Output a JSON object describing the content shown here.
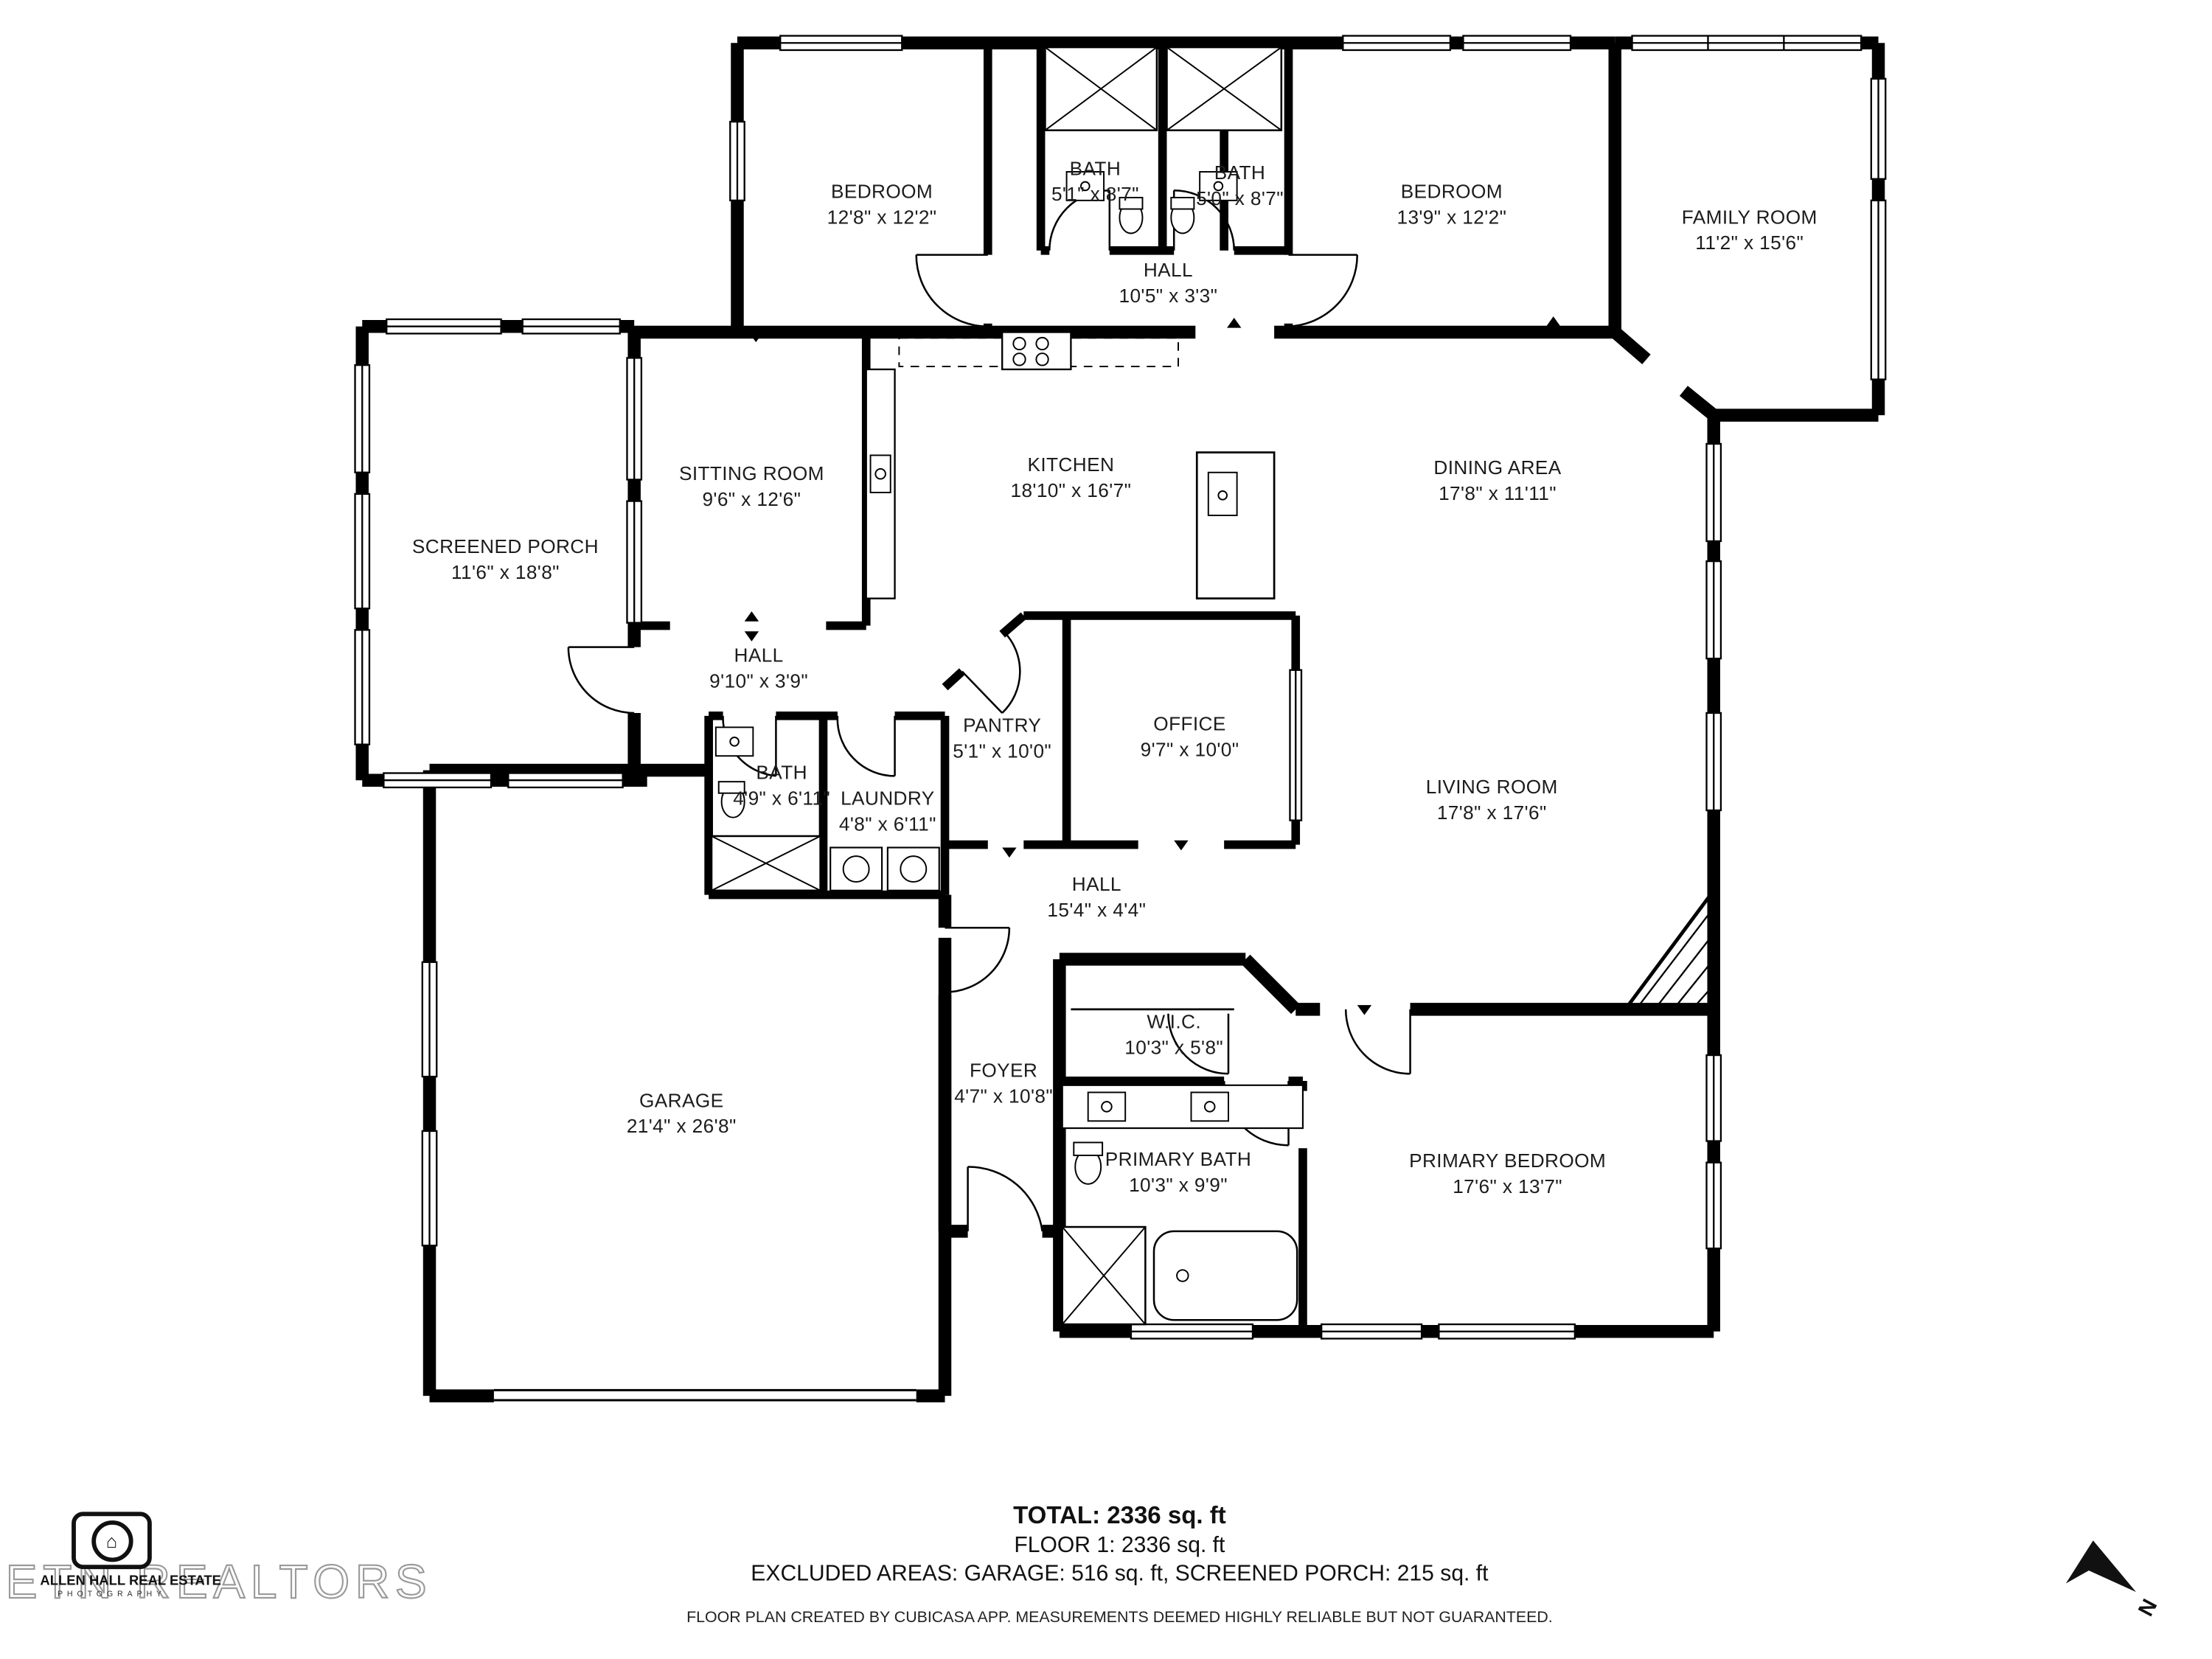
{
  "rooms": [
    {
      "name": "BEDROOM",
      "dims": "12'8\" x 12'2\""
    },
    {
      "name": "BATH",
      "dims": "5'1\" x 8'7\""
    },
    {
      "name": "BATH",
      "dims": "5'0\" x 8'7\""
    },
    {
      "name": "BEDROOM",
      "dims": "13'9\" x 12'2\""
    },
    {
      "name": "FAMILY ROOM",
      "dims": "11'2\" x 15'6\""
    },
    {
      "name": "HALL",
      "dims": "10'5\" x 3'3\""
    },
    {
      "name": "SITTING ROOM",
      "dims": "9'6\" x 12'6\""
    },
    {
      "name": "KITCHEN",
      "dims": "18'10\" x 16'7\""
    },
    {
      "name": "DINING AREA",
      "dims": "17'8\" x 11'11\""
    },
    {
      "name": "SCREENED PORCH",
      "dims": "11'6\" x 18'8\""
    },
    {
      "name": "HALL",
      "dims": "9'10\" x 3'9\""
    },
    {
      "name": "PANTRY",
      "dims": "5'1\" x 10'0\""
    },
    {
      "name": "OFFICE",
      "dims": "9'7\" x 10'0\""
    },
    {
      "name": "BATH",
      "dims": "4'9\" x 6'11\""
    },
    {
      "name": "LAUNDRY",
      "dims": "4'8\" x 6'11\""
    },
    {
      "name": "LIVING ROOM",
      "dims": "17'8\" x 17'6\""
    },
    {
      "name": "HALL",
      "dims": "15'4\" x 4'4\""
    },
    {
      "name": "W.I.C.",
      "dims": "10'3\" x 5'8\""
    },
    {
      "name": "GARAGE",
      "dims": "21'4\" x 26'8\""
    },
    {
      "name": "FOYER",
      "dims": "4'7\" x 10'8\""
    },
    {
      "name": "PRIMARY BATH",
      "dims": "10'3\" x 9'9\""
    },
    {
      "name": "PRIMARY BEDROOM",
      "dims": "17'6\" x 13'7\""
    }
  ],
  "summary": {
    "total": "TOTAL: 2336 sq. ft",
    "floor1": "FLOOR 1: 2336 sq. ft",
    "excluded": "EXCLUDED AREAS: GARAGE: 516 sq. ft, SCREENED PORCH: 215 sq. ft",
    "disclaimer": "FLOOR PLAN CREATED BY CUBICASA APP. MEASUREMENTS DEEMED HIGHLY RELIABLE BUT NOT GUARANTEED."
  },
  "branding": {
    "logo_line1": "ALLEN HALL REAL ESTATE",
    "logo_line2": "PHOTOGRAPHY",
    "logo_glyph": "⌂",
    "watermark": "ETN REALTORS"
  },
  "compass": {
    "label": "N"
  },
  "colors": {
    "wall": "#000000",
    "background": "#ffffff",
    "label_text": "#1c1c1c",
    "watermark_outline": "#9a9a9a"
  }
}
